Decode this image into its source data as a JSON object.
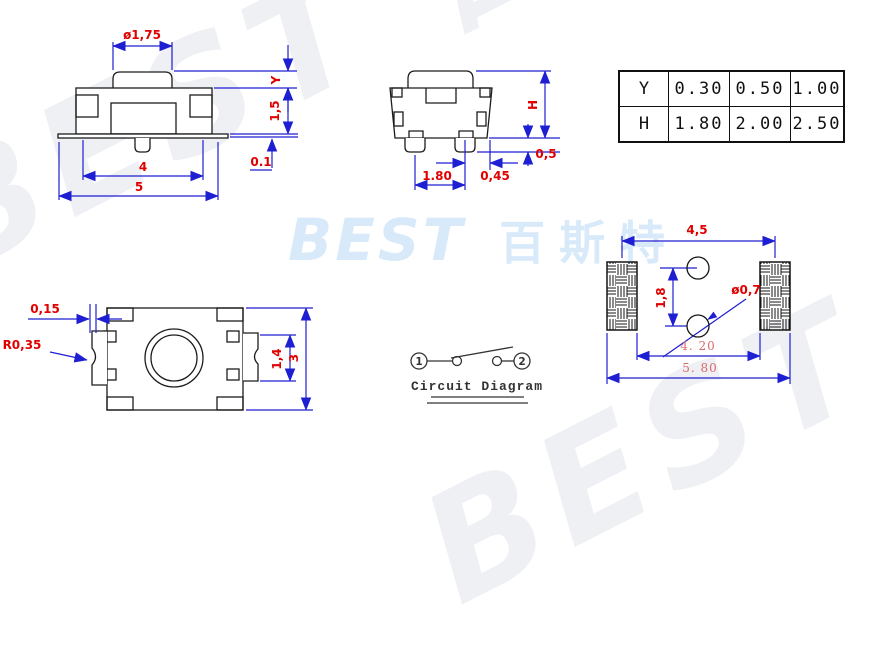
{
  "watermarks": {
    "background_text": "BEST 百斯特",
    "center_logo_latin": "BEST",
    "center_logo_cjk": "百斯特",
    "logo_color": "#d8eafa"
  },
  "spec_table": {
    "rows": [
      {
        "label": "Y",
        "values": [
          "0.30",
          "0.50",
          "1.00"
        ]
      },
      {
        "label": "H",
        "values": [
          "1.80",
          "2.00",
          "2.50"
        ]
      }
    ]
  },
  "views": {
    "front": {
      "dims": {
        "button_dia": "ø1,75",
        "overtravel": "Y",
        "body_height": "1,5",
        "standoff": "0.1",
        "inner_width": "4",
        "total_width": "5"
      }
    },
    "side": {
      "dims": {
        "height": "H",
        "leg_height": "0,5",
        "leg_pitch": "1.80",
        "leg_offset": "0,45"
      }
    },
    "top": {
      "dims": {
        "notch_depth": "0,15",
        "notch_radius": "R0,35",
        "terminal_height": "1,4",
        "body_depth": "3"
      }
    },
    "footprint": {
      "dims": {
        "pad_pitch": "4,5",
        "hole_pitch": "1,8",
        "hole_dia": "ø0,7",
        "pad_inner_span": "4. 20",
        "pad_outer_span": "5. 80"
      }
    },
    "circuit": {
      "terminal_1": "1",
      "terminal_2": "2",
      "caption": "Circuit Diagram"
    }
  },
  "colors": {
    "dimension_blue": "#1e1ed2",
    "label_red": "#e00000",
    "label_pink": "#d96a6a",
    "outline_black": "#1c1c1c",
    "watermark_blue": "#d8eafa"
  }
}
